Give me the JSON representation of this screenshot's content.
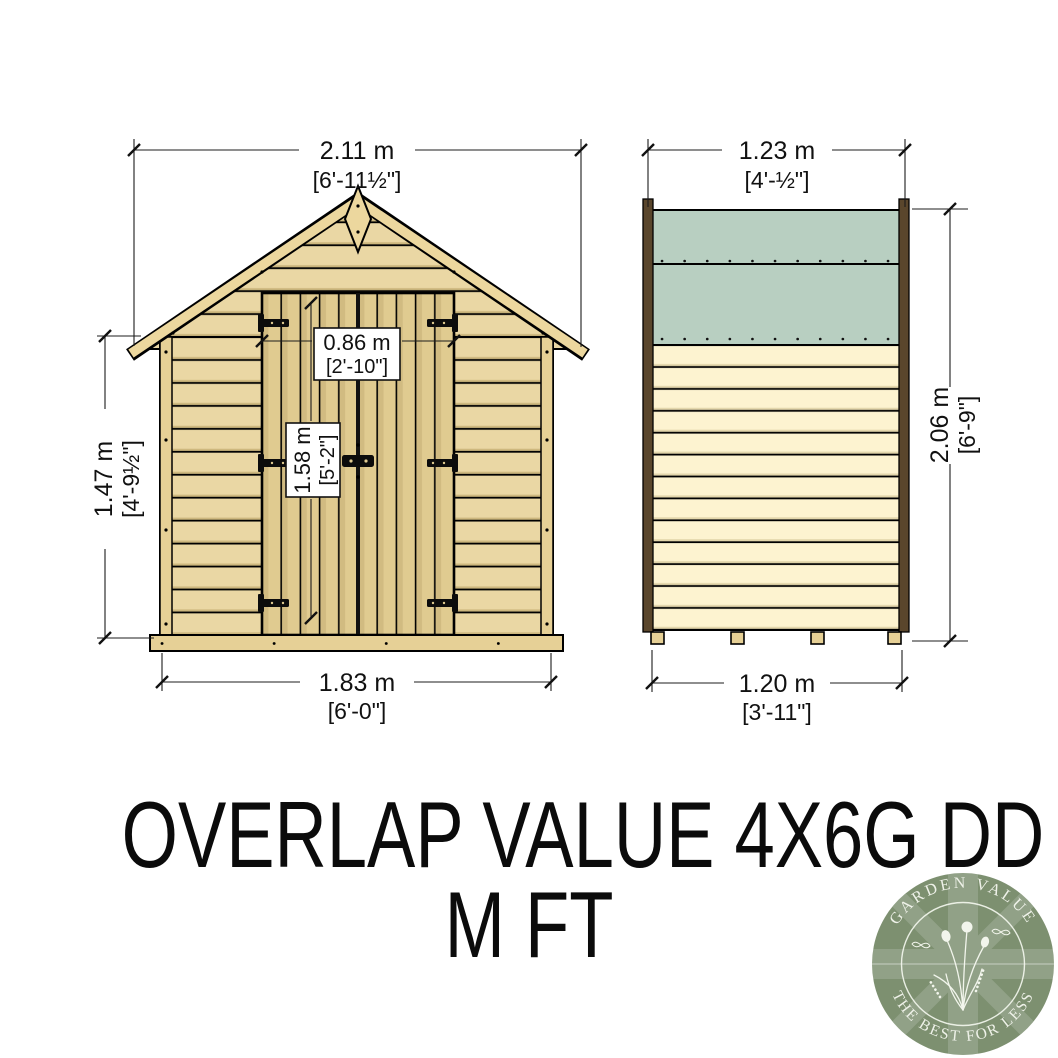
{
  "diagram": {
    "front_view": {
      "roof_width": {
        "metric": "2.11 m",
        "imperial": "[6'-11½\"]"
      },
      "eaves_height": {
        "metric": "1.47 m",
        "imperial": "[4'-9½\"]"
      },
      "door_width": {
        "metric": "0.86 m",
        "imperial": "[2'-10\"]"
      },
      "door_height": {
        "metric": "1.58 m",
        "imperial": "[5'-2\"]"
      },
      "base_width": {
        "metric": "1.83 m",
        "imperial": "[6'-0\"]"
      }
    },
    "side_view": {
      "roof_depth": {
        "metric": "1.23 m",
        "imperial": "[4'-½\"]"
      },
      "ridge_height": {
        "metric": "2.06 m",
        "imperial": "[6'-9\"]"
      },
      "base_depth": {
        "metric": "1.20 m",
        "imperial": "[3'-11\"]"
      }
    }
  },
  "title": {
    "line1": "OVERLAP VALUE 4X6G DD",
    "line2": "M FT"
  },
  "logo": {
    "arc_top": "GARDEN VALUE",
    "arc_bottom": "THE BEST FOR LESS"
  },
  "colors": {
    "wood": "#ead7a4",
    "wood_dark": "#e0cb90",
    "trim_wood": "#e6d096",
    "barge_wood": "#ecd79e",
    "roof_felt": "#b8cfc1",
    "side_cladding": "#fdf3d0",
    "corner_trim": "#5a462c",
    "logo_green": "#7d9070",
    "ink": "#111111"
  }
}
